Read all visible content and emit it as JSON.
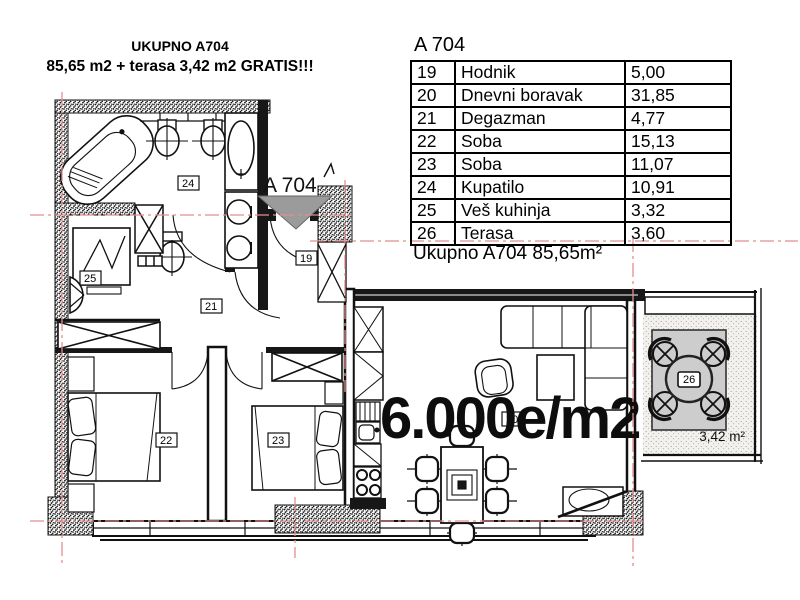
{
  "header": {
    "line1": "UKUPNO A704",
    "line2": "85,65 m2 + terasa 3,42 m2 GRATIS!!!"
  },
  "area_table": {
    "title": "A 704",
    "rows": [
      {
        "num": "19",
        "name": "Hodnik",
        "area": "5,00"
      },
      {
        "num": "20",
        "name": "Dnevni boravak",
        "area": "31,85"
      },
      {
        "num": "21",
        "name": "Degazman",
        "area": "4,77"
      },
      {
        "num": "22",
        "name": "Soba",
        "area": "15,13"
      },
      {
        "num": "23",
        "name": "Soba",
        "area": "11,07"
      },
      {
        "num": "24",
        "name": "Kupatilo",
        "area": "10,91"
      },
      {
        "num": "25",
        "name": "Veš kuhinja",
        "area": "3,32"
      },
      {
        "num": "26",
        "name": "Terasa",
        "area": "3,60"
      }
    ],
    "total": "Ukupno A704 85,65m²"
  },
  "plan": {
    "price": "6.000e/m2",
    "entrance": "A 704",
    "terrace_area": "3,42 m²",
    "rooms": {
      "hodnik": "19",
      "dnevni": "20",
      "degazman": "21",
      "soba22": "22",
      "soba23": "23",
      "kupatilo": "24",
      "ves": "25",
      "terasa": "26"
    }
  },
  "colors": {
    "centerline": "#e08f8f",
    "wall_dark": "#171717",
    "arrow_gray": "#9b9b9b",
    "mat_gray": "#cdcdcd"
  }
}
